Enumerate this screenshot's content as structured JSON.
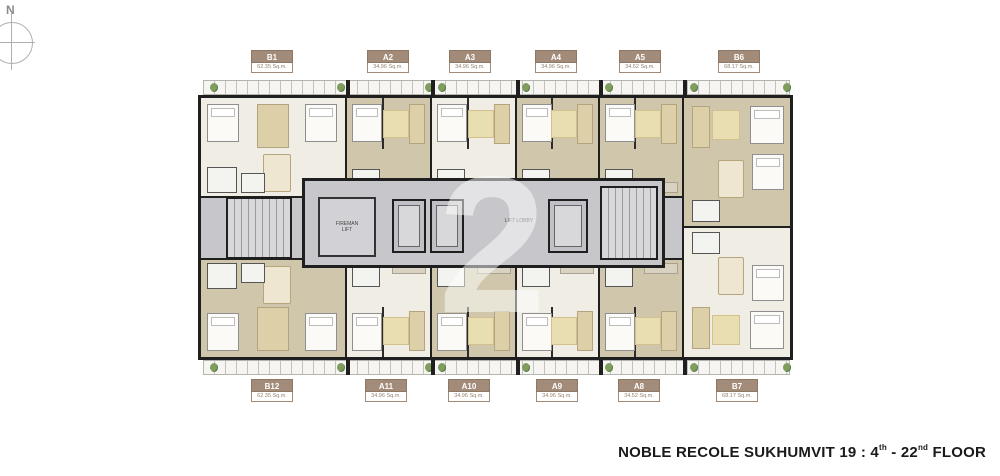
{
  "compass": {
    "label": "N"
  },
  "watermark": {
    "glyph": "2"
  },
  "core": {
    "fireman_lift_label": "FIREMAN LIFT",
    "lift_lobby_label": "LIFT LOBBY"
  },
  "units_top": [
    {
      "code": "B1",
      "area": "62.35 Sq.m."
    },
    {
      "code": "A2",
      "area": "34.96 Sq.m."
    },
    {
      "code": "A3",
      "area": "34.96 Sq.m."
    },
    {
      "code": "A4",
      "area": "34.96 Sq.m."
    },
    {
      "code": "A5",
      "area": "34.52 Sq.m."
    },
    {
      "code": "B6",
      "area": "68.17 Sq.m."
    }
  ],
  "units_bottom": [
    {
      "code": "B12",
      "area": "62.35 Sq.m."
    },
    {
      "code": "A11",
      "area": "34.96 Sq.m."
    },
    {
      "code": "A10",
      "area": "34.96 Sq.m."
    },
    {
      "code": "A9",
      "area": "34.96 Sq.m."
    },
    {
      "code": "A8",
      "area": "34.52 Sq.m."
    },
    {
      "code": "B7",
      "area": "68.17 Sq.m."
    }
  ],
  "footer": {
    "part1": "NOBLE RECOLE SUKHUMVIT 19 : 4",
    "sup1": "th",
    "part2": "- 22",
    "sup2": "nd",
    "part3": "FLOOR"
  },
  "colors": {
    "wall": "#1f1f1f",
    "floor_light": "#f0ede5",
    "floor_olive": "#cfc6ab",
    "floor_beige": "#e0d8c2",
    "corridor": "#c7c7cb",
    "label_brown": "#a28b79",
    "area_text": "#95806e",
    "balcony": "#f6f5f1",
    "rail": "#c2c2c2",
    "plant": "#7f9e5e",
    "furn_tan": "#ddd0a9",
    "bed_white": "#fbfaf7",
    "title": "#1a1a1a"
  }
}
